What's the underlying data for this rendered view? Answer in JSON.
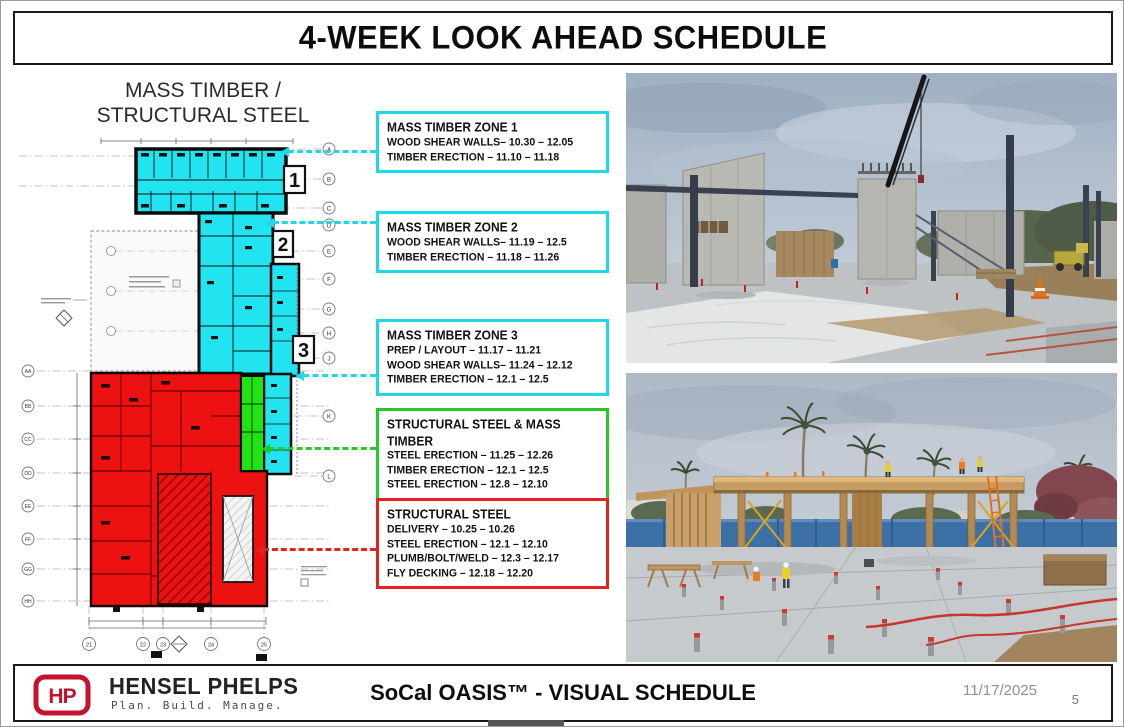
{
  "slide": {
    "title": "4-WEEK LOOK AHEAD SCHEDULE"
  },
  "plan": {
    "heading_line1": "MASS TIMBER /",
    "heading_line2": "STRUCTURAL STEEL",
    "zone_markers": [
      "1",
      "2",
      "3"
    ],
    "grid_right": [
      "A",
      "B",
      "C",
      "D",
      "E",
      "F",
      "G",
      "H",
      "J",
      "K",
      "L"
    ],
    "grid_left": [
      "AA",
      "BB",
      "CC",
      "DD",
      "EE",
      "FF",
      "GG",
      "HH"
    ],
    "grid_bottom": [
      "21",
      "22",
      "23",
      "24",
      "25"
    ],
    "zone_colors": {
      "mass_timber": "#22e3f0",
      "structural_steel": "#ee1111",
      "steel_and_timber": "#22e312"
    }
  },
  "callouts": [
    {
      "color": "#1fd8e6",
      "title": "MASS TIMBER ZONE 1",
      "lines": [
        "WOOD SHEAR WALLS– 10.30 – 12.05",
        "TIMBER ERECTION – 11.10 – 11.18"
      ]
    },
    {
      "color": "#1fd8e6",
      "title": "MASS TIMBER ZONE 2",
      "lines": [
        "WOOD SHEAR WALLS– 11.19 – 12.5",
        "TIMBER ERECTION – 11.18 – 11.26"
      ]
    },
    {
      "color": "#1fd8e6",
      "title": "MASS TIMBER ZONE 3",
      "lines": [
        "PREP / LAYOUT – 11.17 – 11.21",
        "WOOD SHEAR WALLS– 11.24 – 12.12",
        "TIMBER ERECTION – 12.1 – 12.5"
      ]
    },
    {
      "color": "#27c927",
      "title": "STRUCTURAL STEEL & MASS TIMBER",
      "lines": [
        "STEEL ERECTION – 11.25 – 12.26",
        "TIMBER ERECTION – 12.1 – 12.5",
        "STEEL ERECTION – 12.8 – 12.10"
      ]
    },
    {
      "color": "#e32222",
      "title": "STRUCTURAL STEEL",
      "lines": [
        "DELIVERY – 10.25 – 10.26",
        "STEEL ERECTION – 12.1 – 12.10",
        "PLUMB/BOLT/WELD – 12.3 – 12.17",
        "FLY DECKING – 12.18 – 12.20"
      ]
    }
  ],
  "photos": [
    {
      "label": "Construction site with concrete tilt-up wall panels, steel columns and crane"
    },
    {
      "label": "Mass timber canopy structure with workers on roof, palm trees and concrete slab"
    }
  ],
  "footer": {
    "logo_text": "HP",
    "company": "HENSEL PHELPS",
    "tagline": "Plan. Build. Manage.",
    "center_title": "SoCal OASIS™ - VISUAL SCHEDULE",
    "date": "11/17/2025",
    "page": "5"
  }
}
